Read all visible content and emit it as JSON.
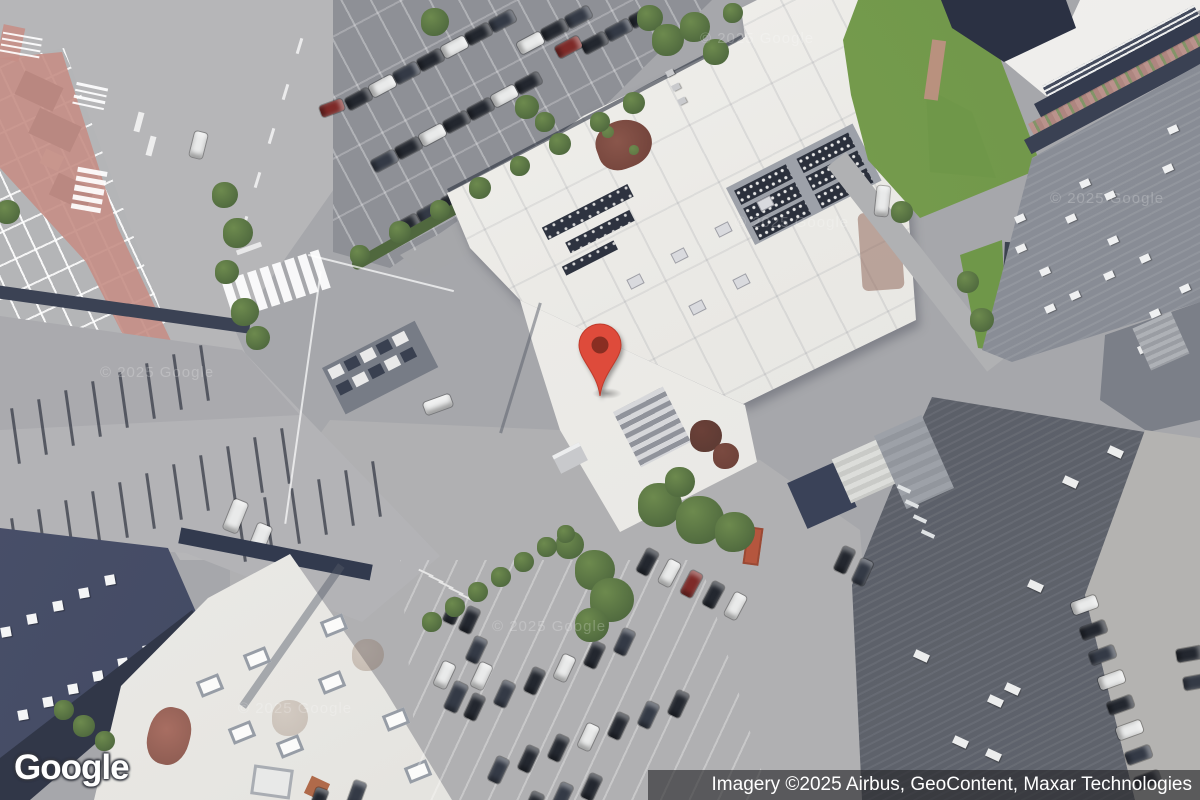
{
  "branding": {
    "logo_text": "Google"
  },
  "attribution": {
    "text": "Imagery ©2025 Airbus, GeoContent, Maxar Technologies"
  },
  "watermark": {
    "text": "© 2025 Google"
  },
  "marker": {
    "color": "#DE4B3B",
    "inner_color": "#7F2B20"
  }
}
